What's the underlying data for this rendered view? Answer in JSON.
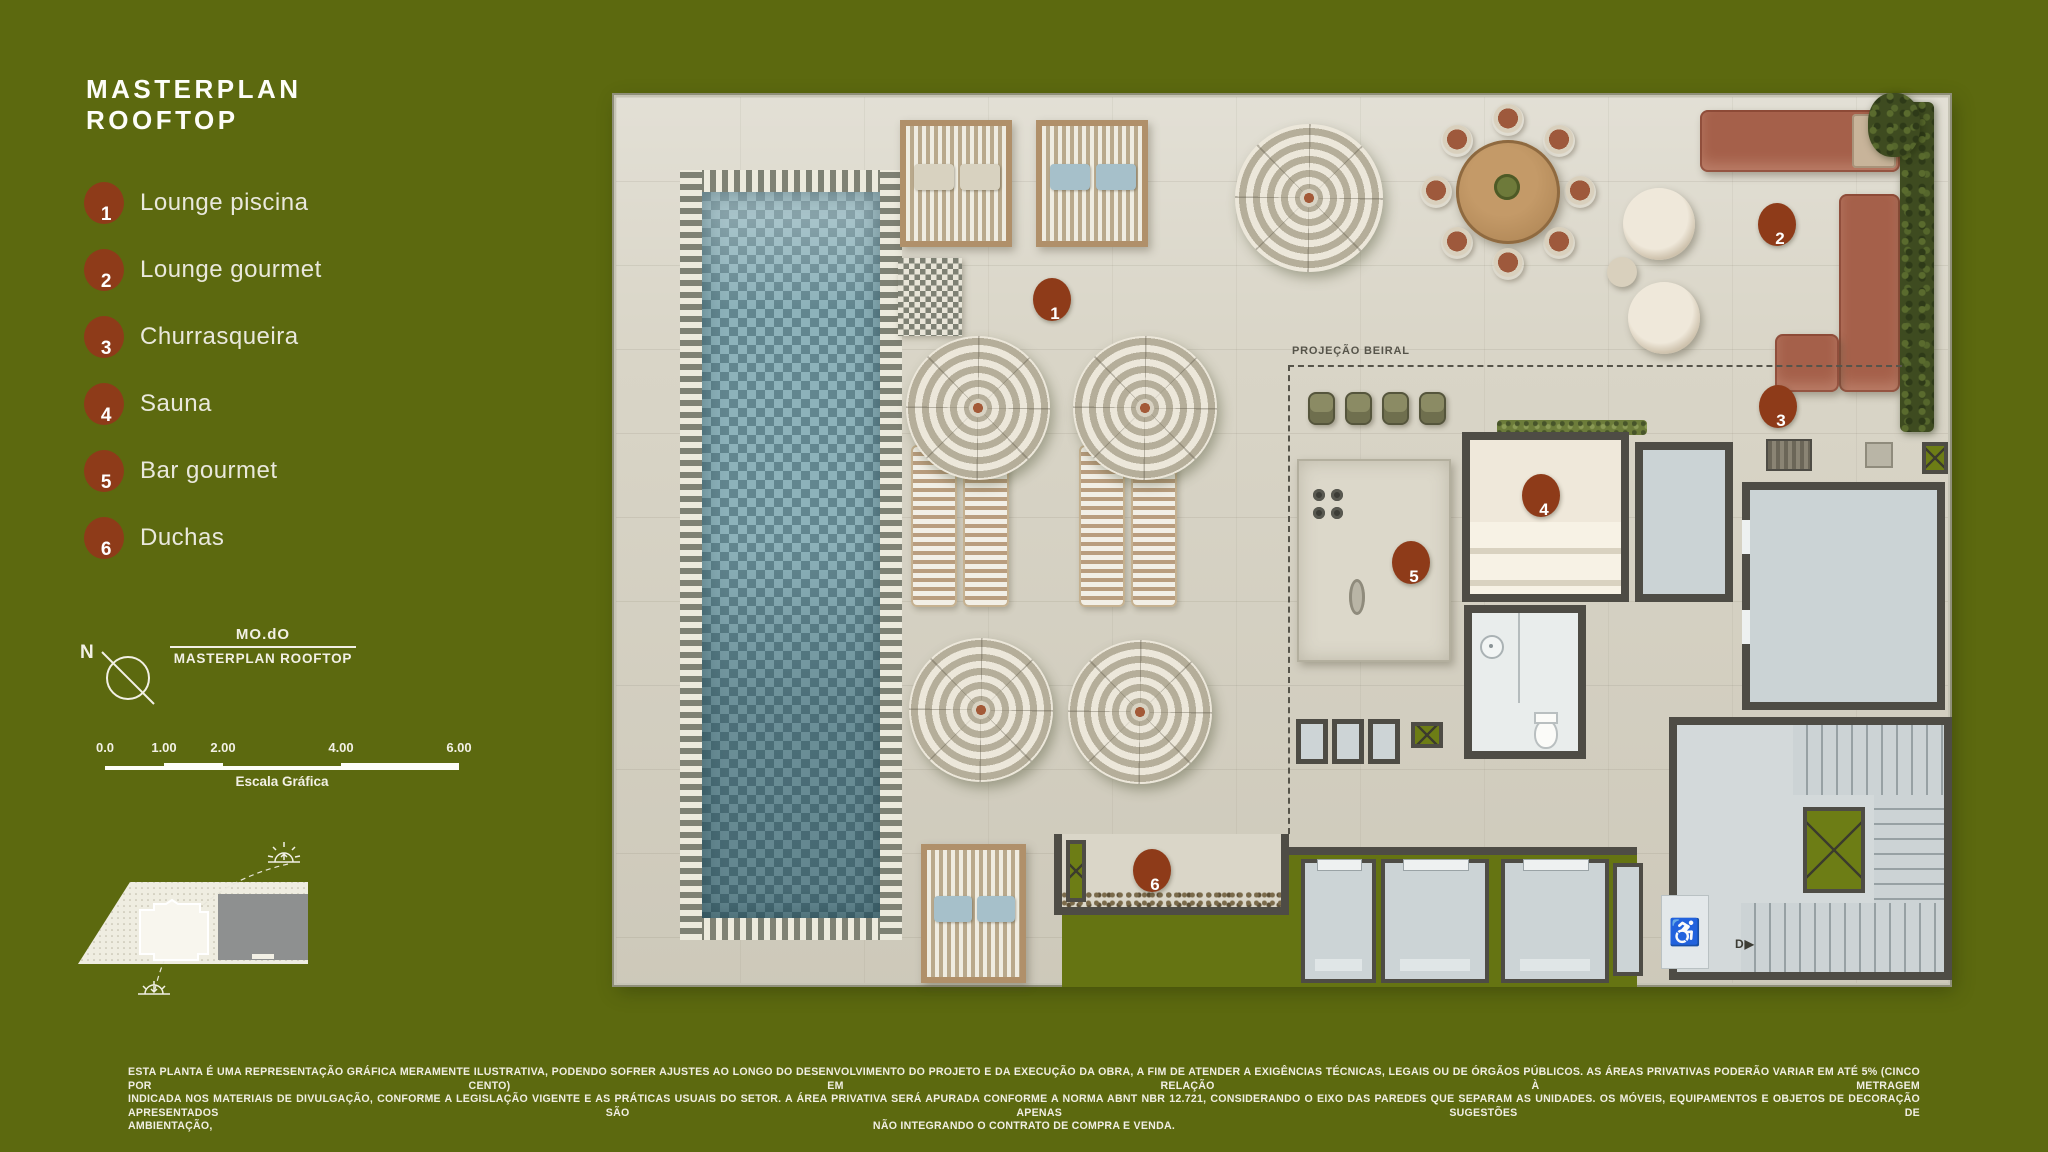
{
  "colors": {
    "background": "#5c690f",
    "marker": "#8e3b19",
    "deck": "#d9d5c7",
    "pool_water": "#7fa3ad",
    "wall": "#4e4c45",
    "room_gray": "#cbd3d5",
    "terracotta": "#a5604a",
    "hedge_green": "#3e4b20",
    "text_light": "#f2f0e5"
  },
  "header": {
    "title": "MASTERPLAN ROOFTOP"
  },
  "legend": {
    "items": [
      {
        "num": "1",
        "label": "Lounge piscina"
      },
      {
        "num": "2",
        "label": "Lounge gourmet"
      },
      {
        "num": "3",
        "label": "Churrasqueira"
      },
      {
        "num": "4",
        "label": "Sauna"
      },
      {
        "num": "5",
        "label": "Bar gourmet"
      },
      {
        "num": "6",
        "label": "Duchas"
      }
    ]
  },
  "compass": {
    "north": "N"
  },
  "title_block": {
    "brand": "MO.dO",
    "plan_name": "MASTERPLAN ROOFTOP"
  },
  "scale_bar": {
    "ticks": [
      {
        "label": "0.0",
        "value": 0
      },
      {
        "label": "1.00",
        "value": 1
      },
      {
        "label": "2.00",
        "value": 2
      },
      {
        "label": "4.00",
        "value": 4
      },
      {
        "label": "6.00",
        "value": 6
      }
    ],
    "max": 6,
    "caption": "Escala Gráfica"
  },
  "site_diagram": {
    "street_label": "...ários da Pátria",
    "sun_top_label": "Nascente",
    "sun_bottom_label": "Poente"
  },
  "plan": {
    "beiral_label": "PROJEÇÃO BEIRAL",
    "stairs_label": "D",
    "markers": [
      {
        "num": "1",
        "x": 1050,
        "y": 297
      },
      {
        "num": "2",
        "x": 1775,
        "y": 222
      },
      {
        "num": "3",
        "x": 1776,
        "y": 404
      },
      {
        "num": "4",
        "x": 1539,
        "y": 493
      },
      {
        "num": "5",
        "x": 1409,
        "y": 560
      },
      {
        "num": "6",
        "x": 1150,
        "y": 868
      }
    ]
  },
  "disclaimer": {
    "line1": "ESTA PLANTA É UMA REPRESENTAÇÃO GRÁFICA MERAMENTE ILUSTRATIVA, PODENDO SOFRER AJUSTES AO LONGO DO DESENVOLVIMENTO DO PROJETO E DA EXECUÇÃO DA OBRA, A FIM DE ATENDER A EXIGÊNCIAS TÉCNICAS, LEGAIS OU DE ÓRGÃOS PÚBLICOS. AS ÁREAS PRIVATIVAS PODERÃO VARIAR EM ATÉ 5% (CINCO POR CENTO) EM RELAÇÃO À METRAGEM",
    "line2": "INDICADA NOS MATERIAIS DE DIVULGAÇÃO, CONFORME A LEGISLAÇÃO VIGENTE E AS PRÁTICAS USUAIS DO SETOR. A ÁREA PRIVATIVA SERÁ APURADA CONFORME A NORMA ABNT NBR 12.721, CONSIDERANDO O EIXO DAS PAREDES QUE SEPARAM AS UNIDADES. OS MÓVEIS, EQUIPAMENTOS E OBJETOS DE DECORAÇÃO APRESENTADOS SÃO APENAS SUGESTÕES DE",
    "line3_left": "AMBIENTAÇÃO,",
    "line3_center": "NÃO INTEGRANDO O CONTRATO DE COMPRA E VENDA."
  }
}
